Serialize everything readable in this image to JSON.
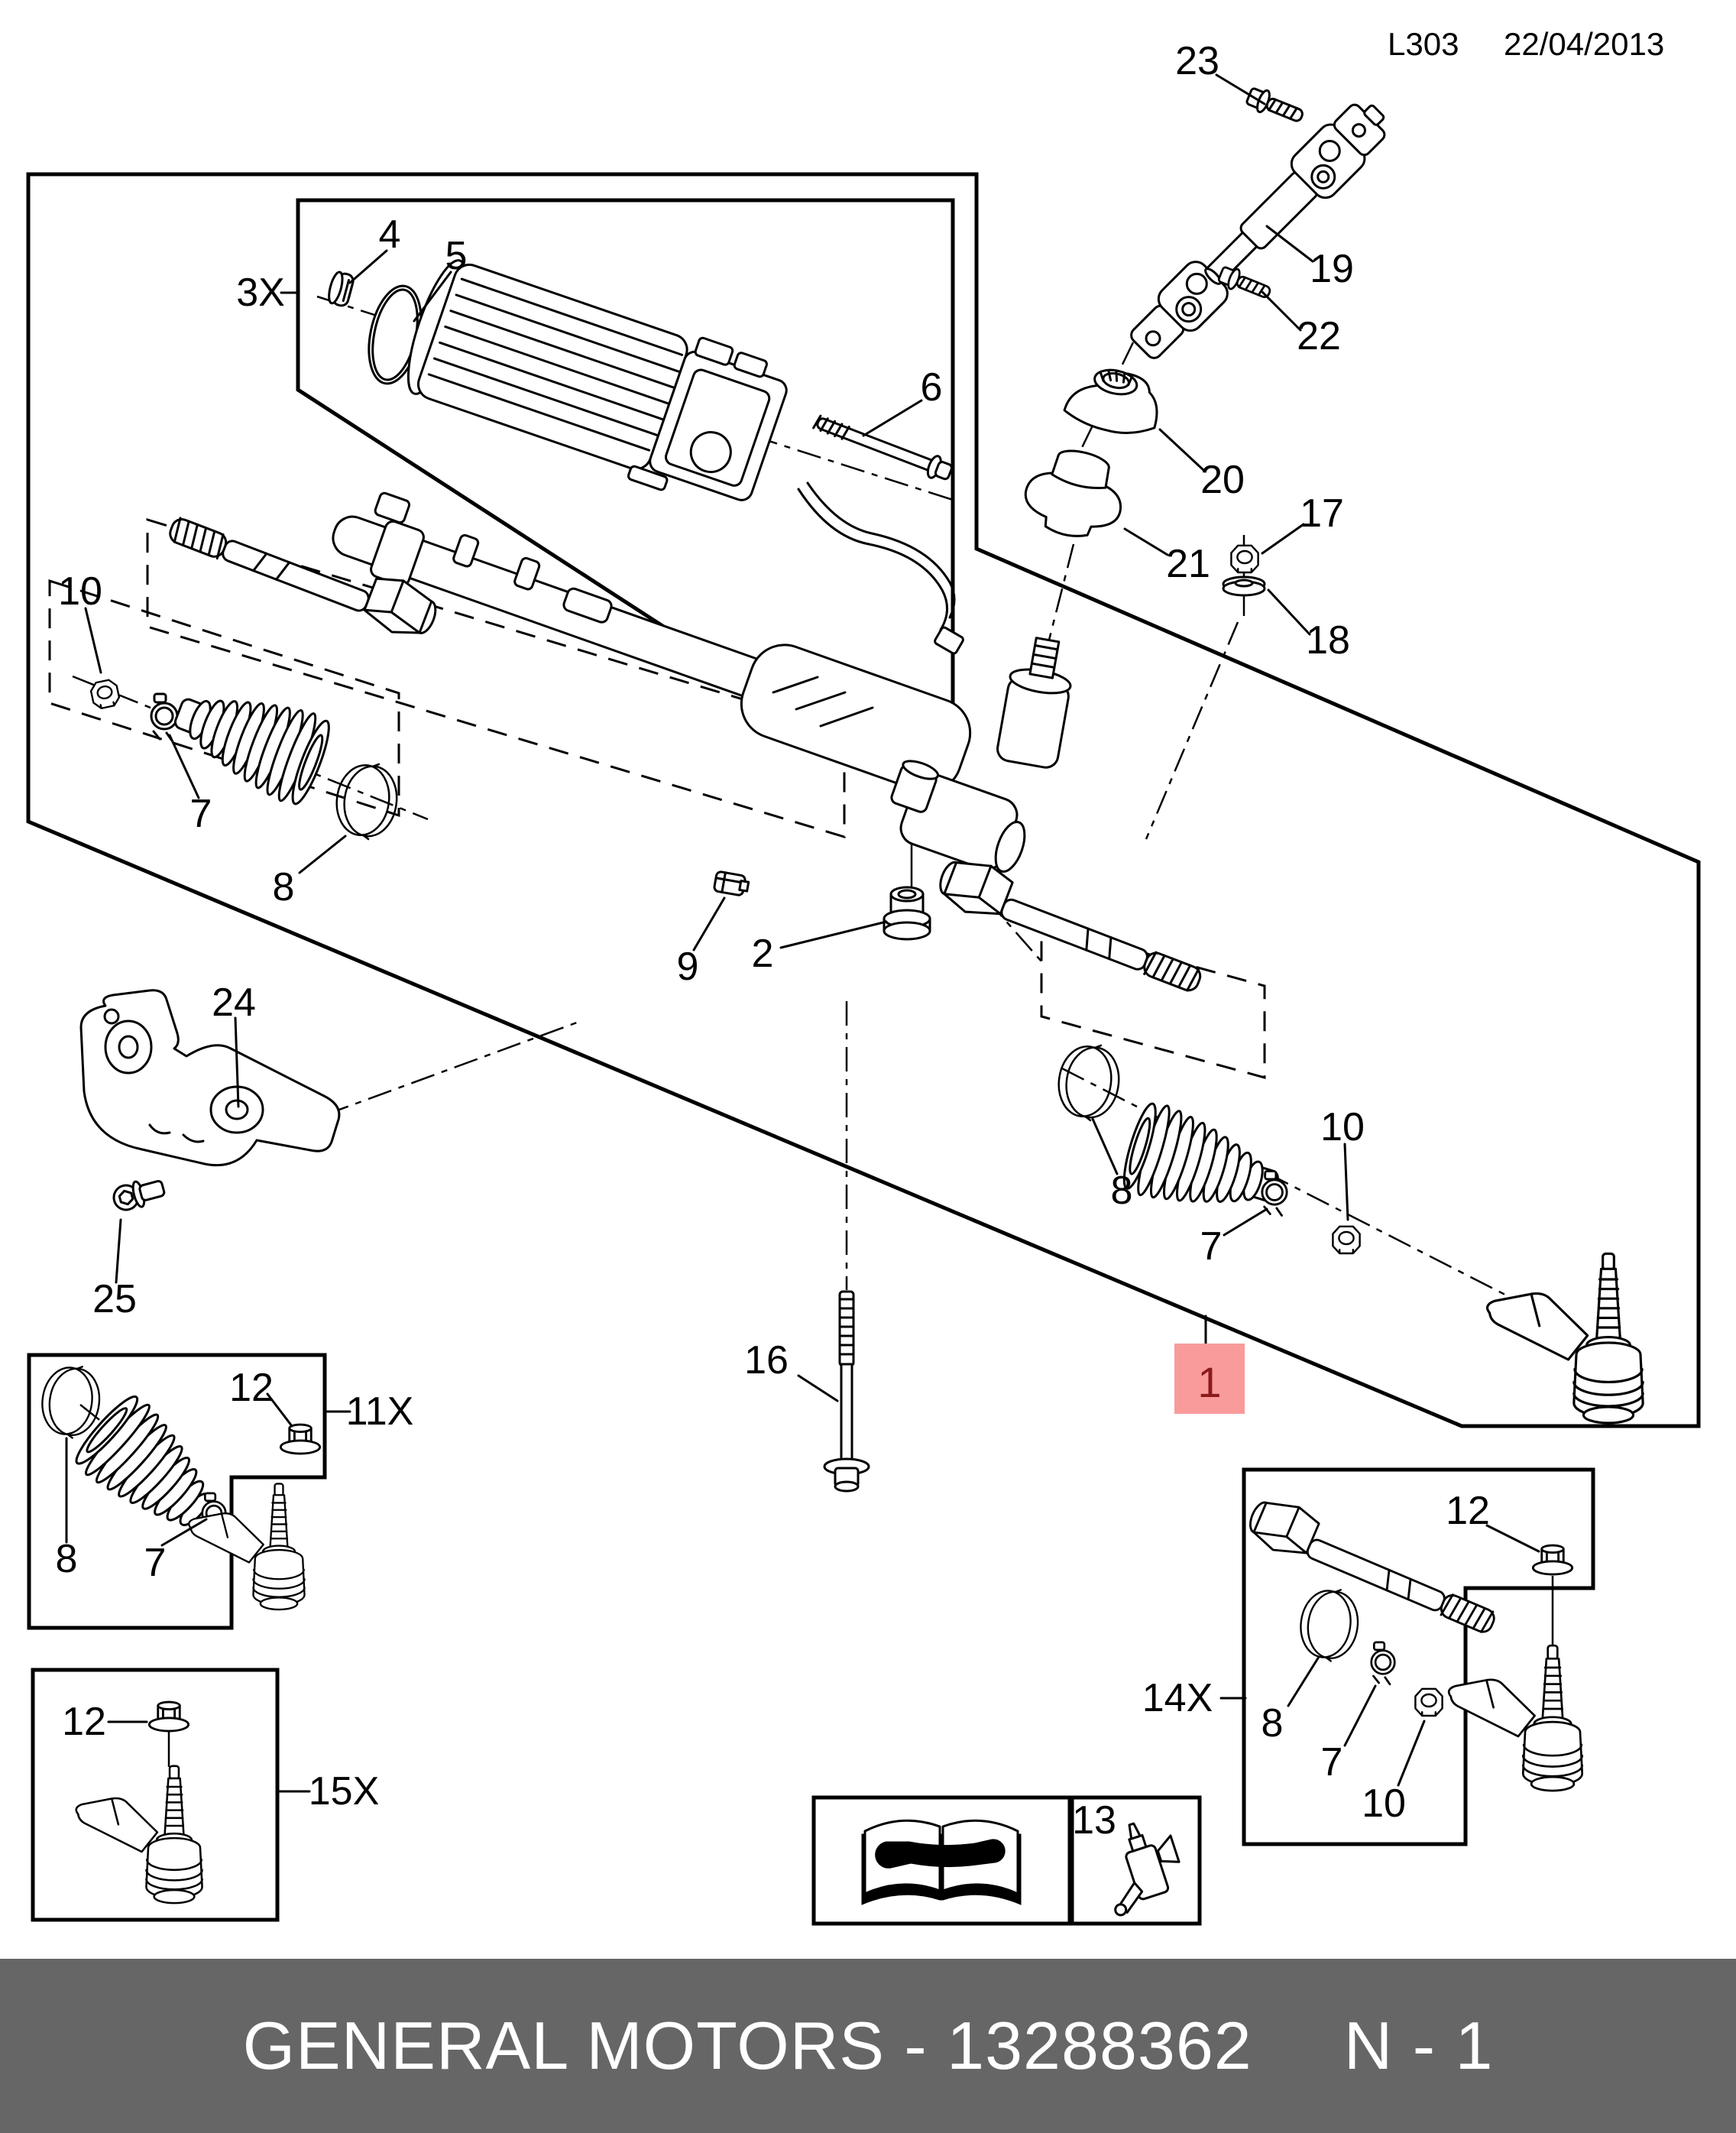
{
  "header": {
    "code": "L303",
    "date": "22/04/2013"
  },
  "footer": {
    "left": "GENERAL MOTORS - 13288362",
    "page": "N - 1"
  },
  "highlight": {
    "label": "1"
  },
  "callouts": {
    "c1": "1",
    "c2": "2",
    "c3x": "3X",
    "c4": "4",
    "c5": "5",
    "c6": "6",
    "c7_left": "7",
    "c7_right": "7",
    "c7_11x": "7",
    "c7_14x": "7",
    "c8_left": "8",
    "c8_right": "8",
    "c8_11x": "8",
    "c8_14x": "8",
    "c9": "9",
    "c10_left": "10",
    "c10_right": "10",
    "c10_14x": "10",
    "c11x": "11X",
    "c12_11x": "12",
    "c12_15x": "12",
    "c12_14x": "12",
    "c13": "13",
    "c14x": "14X",
    "c15x": "15X",
    "c16": "16",
    "c17": "17",
    "c18": "18",
    "c19": "19",
    "c20": "20",
    "c21": "21",
    "c22": "22",
    "c23": "23",
    "c24": "24",
    "c25": "25"
  },
  "colors": {
    "page-bg": "#ffffff",
    "line": "#000000",
    "footer-bg": "#666666",
    "footer-text": "#ffffff",
    "highlight-bg": "#f99b9b",
    "highlight-text": "#8b1a1a"
  }
}
